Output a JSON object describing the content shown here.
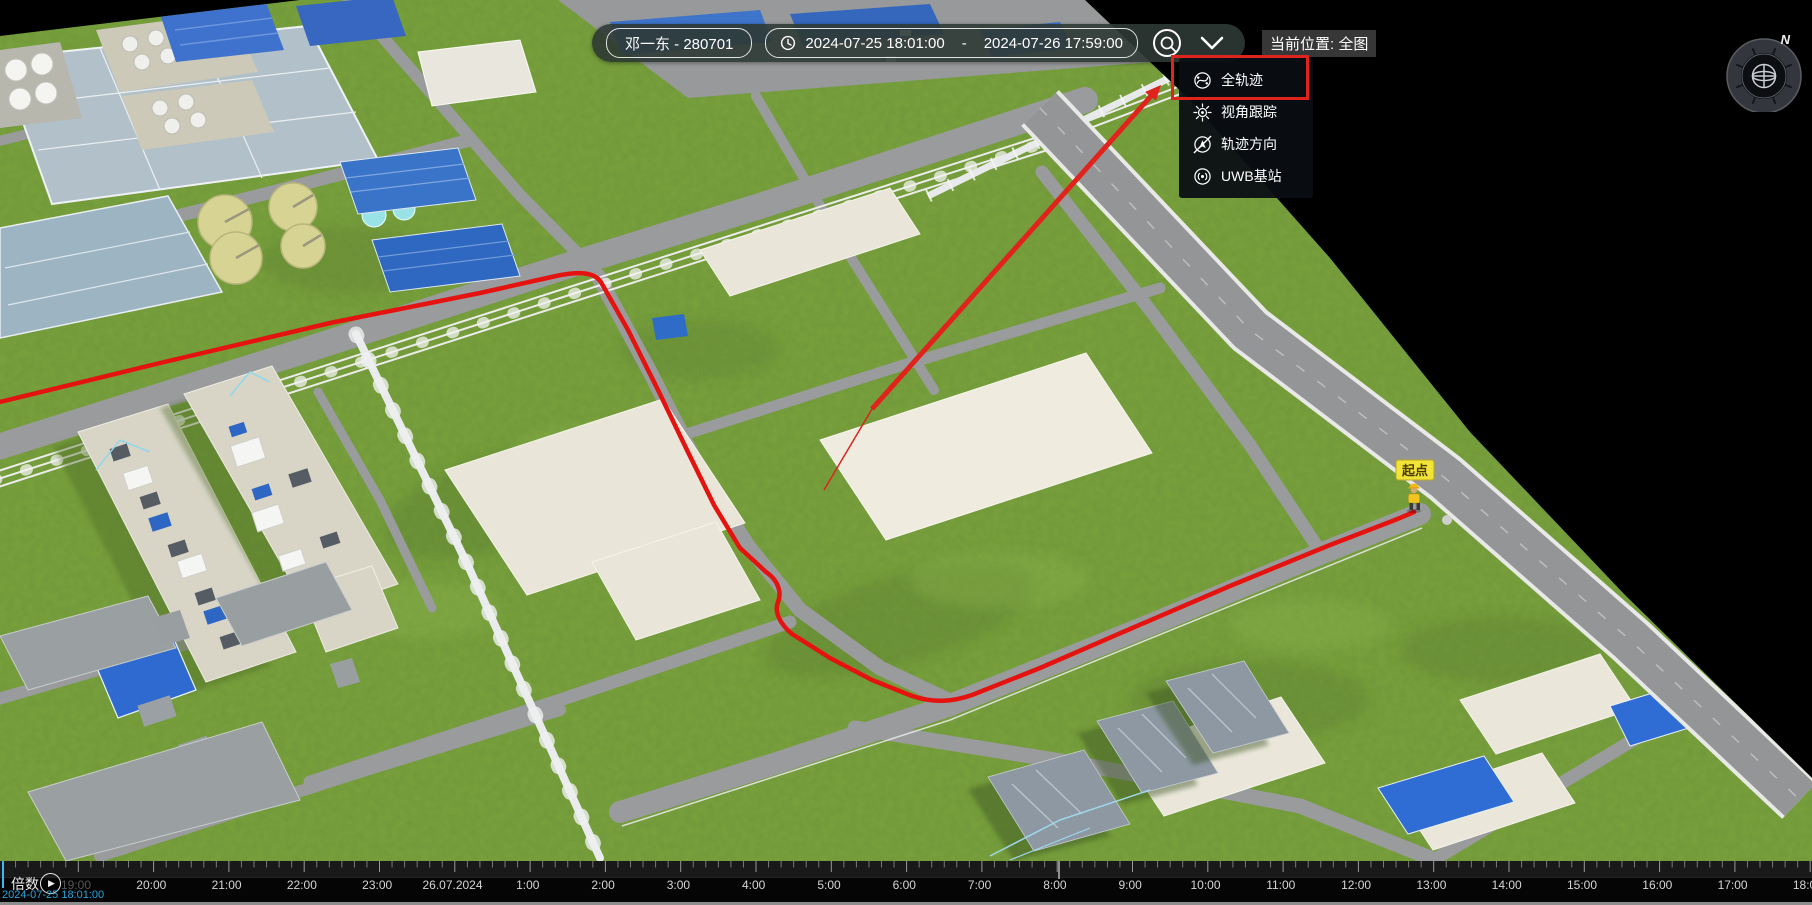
{
  "header": {
    "person": "邓一东 - 280701",
    "time_start": "2024-07-25 18:01:00",
    "time_sep": "-",
    "time_end": "2024-07-26 17:59:00",
    "location_label": "当前位置: 全图"
  },
  "menu": {
    "items": [
      {
        "label": "全轨迹",
        "icon": "full-trajectory-icon",
        "highlighted": true
      },
      {
        "label": "视角跟踪",
        "icon": "view-follow-icon",
        "highlighted": false
      },
      {
        "label": "轨迹方向",
        "icon": "trajectory-direction-icon",
        "highlighted": false
      },
      {
        "label": "UWB基站",
        "icon": "uwb-station-icon",
        "highlighted": false
      }
    ]
  },
  "map": {
    "start_label": "起点",
    "compass_n": "N"
  },
  "timeline": {
    "speed_label": "倍数",
    "current_time": "2024-07-25 18:01:00",
    "play_glyph": "▶",
    "ticks": [
      "19:00",
      "20:00",
      "21:00",
      "22:00",
      "23:00",
      "26.07.2024",
      "1:00",
      "2:00",
      "3:00",
      "4:00",
      "5:00",
      "6:00",
      "7:00",
      "8:00",
      "9:00",
      "10:00",
      "11:00",
      "12:00",
      "13:00",
      "14:00",
      "15:00",
      "16:00",
      "17:00",
      "18:00"
    ],
    "dim_first": true
  },
  "colors": {
    "annotation_red": "#e0231d",
    "trajectory_red": "#e51310",
    "playhead_blue": "#39b9ec",
    "start_label_yellow": "#f1e338",
    "grass_green": "#79a23b"
  }
}
